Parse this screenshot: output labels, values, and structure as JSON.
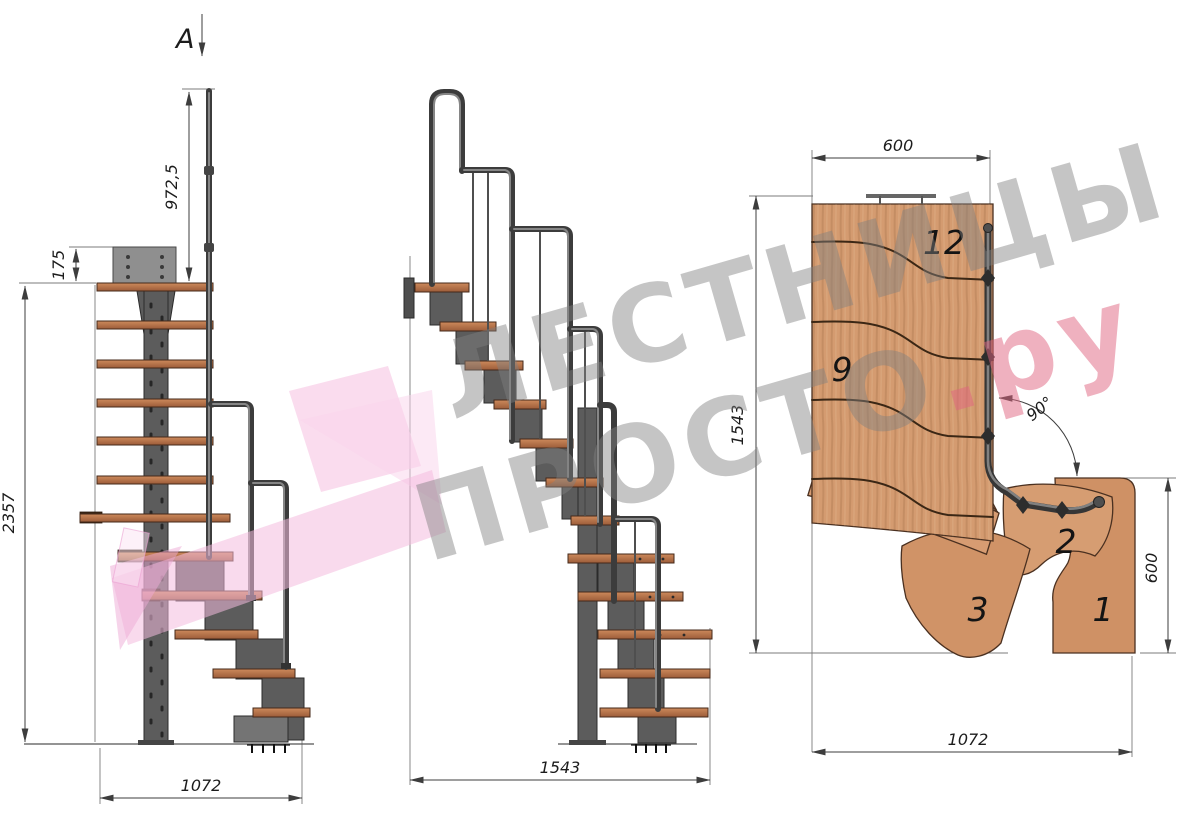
{
  "watermark": {
    "line1": "ЛЕСТНИЦЫ",
    "line2": "ПРОСТО",
    "suffix": ".ру"
  },
  "views": {
    "side_elevation": {
      "section_label": "A",
      "dimensions": {
        "handrail_height": "972,5",
        "mount_plate_offset": "175",
        "total_height": "2357",
        "run_length": "1072"
      }
    },
    "front_elevation": {
      "dimensions": {
        "total_width": "1543"
      }
    },
    "plan_view": {
      "dimensions": {
        "upper_flight_width": "600",
        "overall_depth": "1543",
        "turn_angle": "90°",
        "lower_flight_width": "600",
        "overall_length": "1072"
      },
      "step_labels": {
        "top": "12",
        "middle": "9",
        "lower_left": "3",
        "lower_center": "2",
        "lower_right": "1"
      }
    }
  },
  "colors": {
    "wood_side": "#b5714a",
    "wood_plan": "#d49b70",
    "metal": "#5c5c5c",
    "dimension": "#3d3d3d",
    "watermark_gray": "#808080",
    "watermark_pink": "#e06e88",
    "logo_pink": "#f4c0e0"
  }
}
